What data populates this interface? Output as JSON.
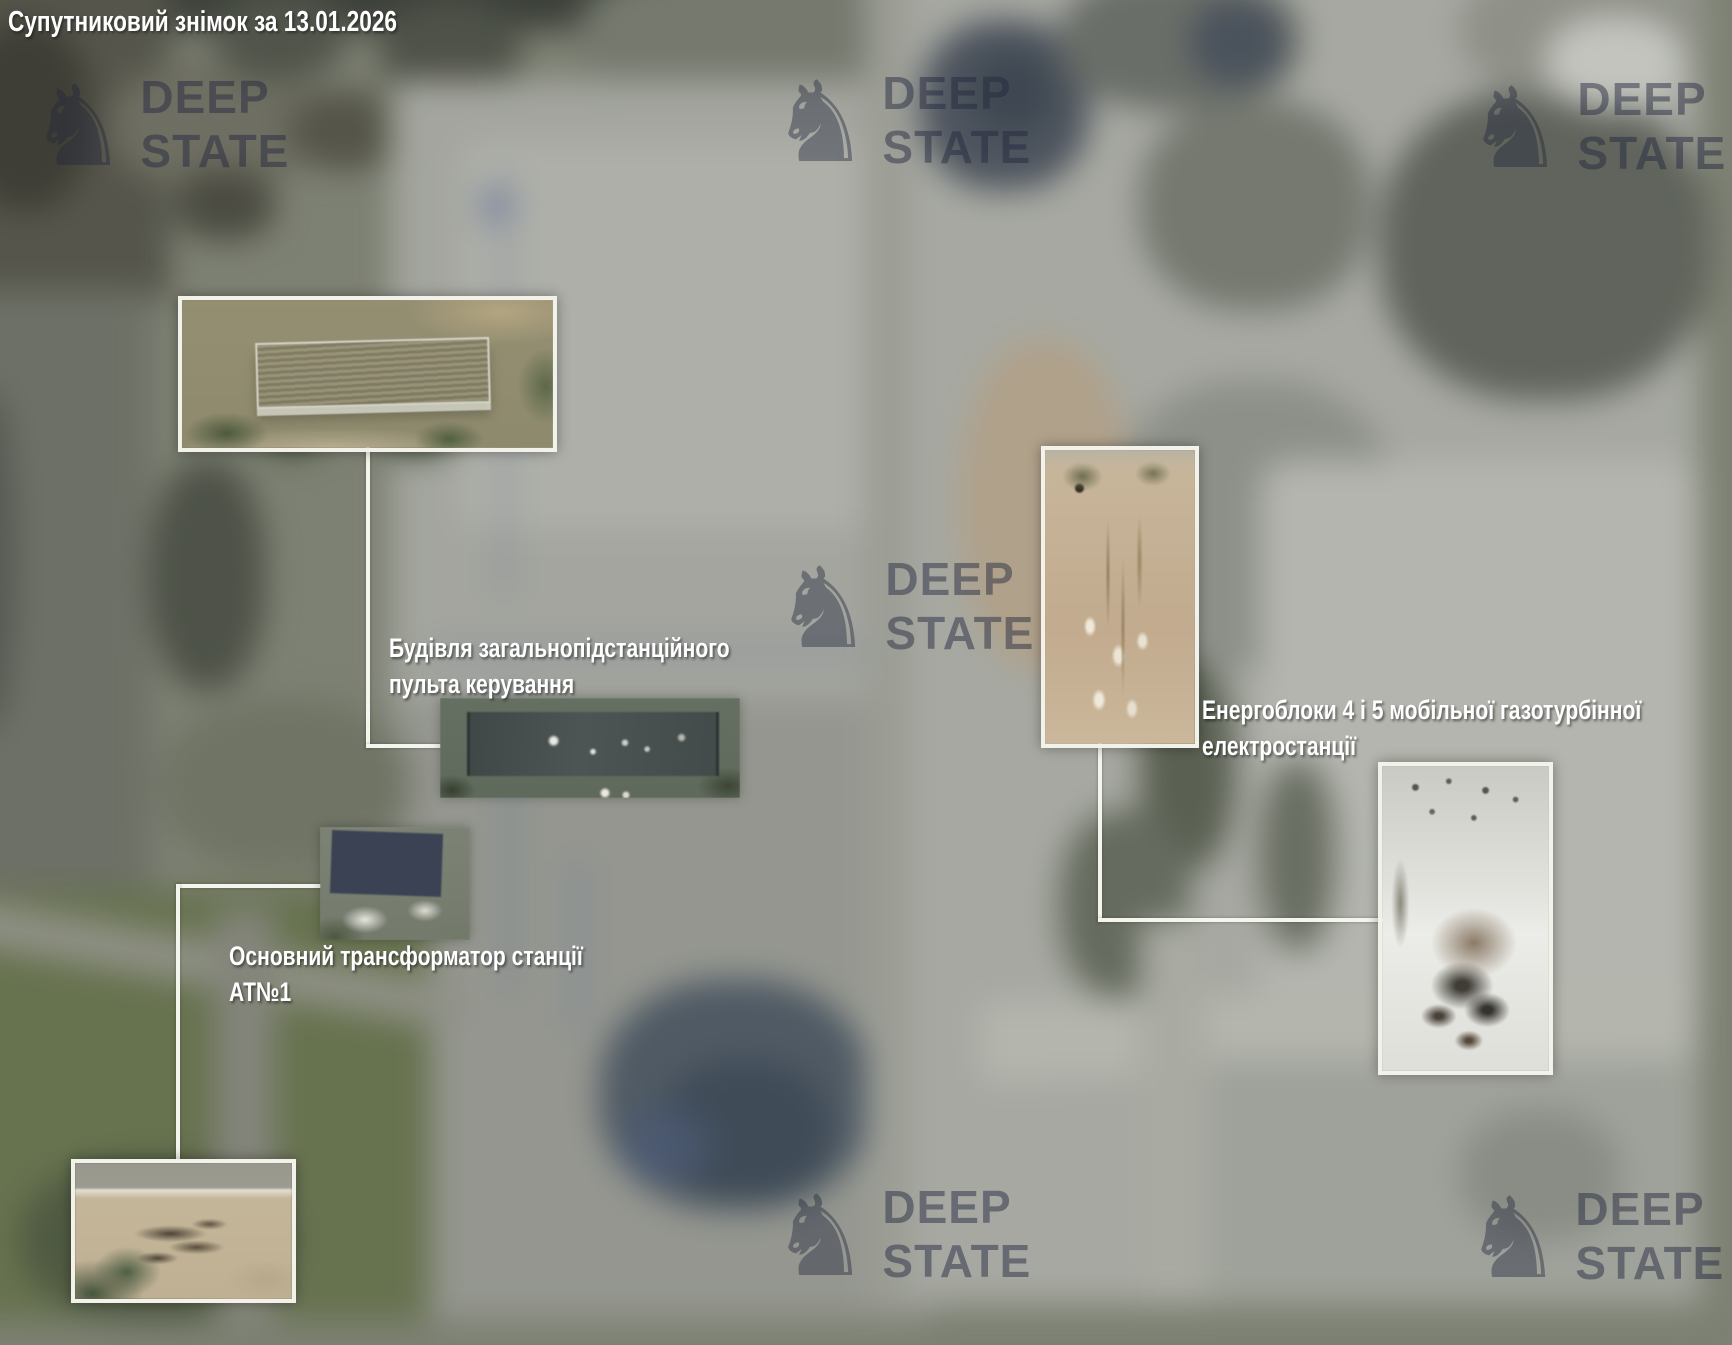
{
  "title": "Супутниковий знімок за 13.01.2026",
  "watermark": {
    "icon": "chess-knight",
    "icon_glyph": "♞",
    "line1": "DEEP",
    "line2": "STATE"
  },
  "annotations": [
    {
      "target": "control-building",
      "line1": "Будівля загальнопідстанційного",
      "line2": "пульта керування"
    },
    {
      "target": "main-transformer-AT1",
      "line1": "Основний трансформатор станції",
      "line2": "АТ№1"
    },
    {
      "target": "power-units-4-5",
      "line1": "Енергоблоки 4 і 5 мобільної газотурбінної",
      "line2": "електростанції"
    }
  ],
  "colors": {
    "label_text": "#ffffff",
    "callout_line": "#f5f5ef",
    "inset_border": "#f2f2ea",
    "watermark": "#24283f"
  }
}
